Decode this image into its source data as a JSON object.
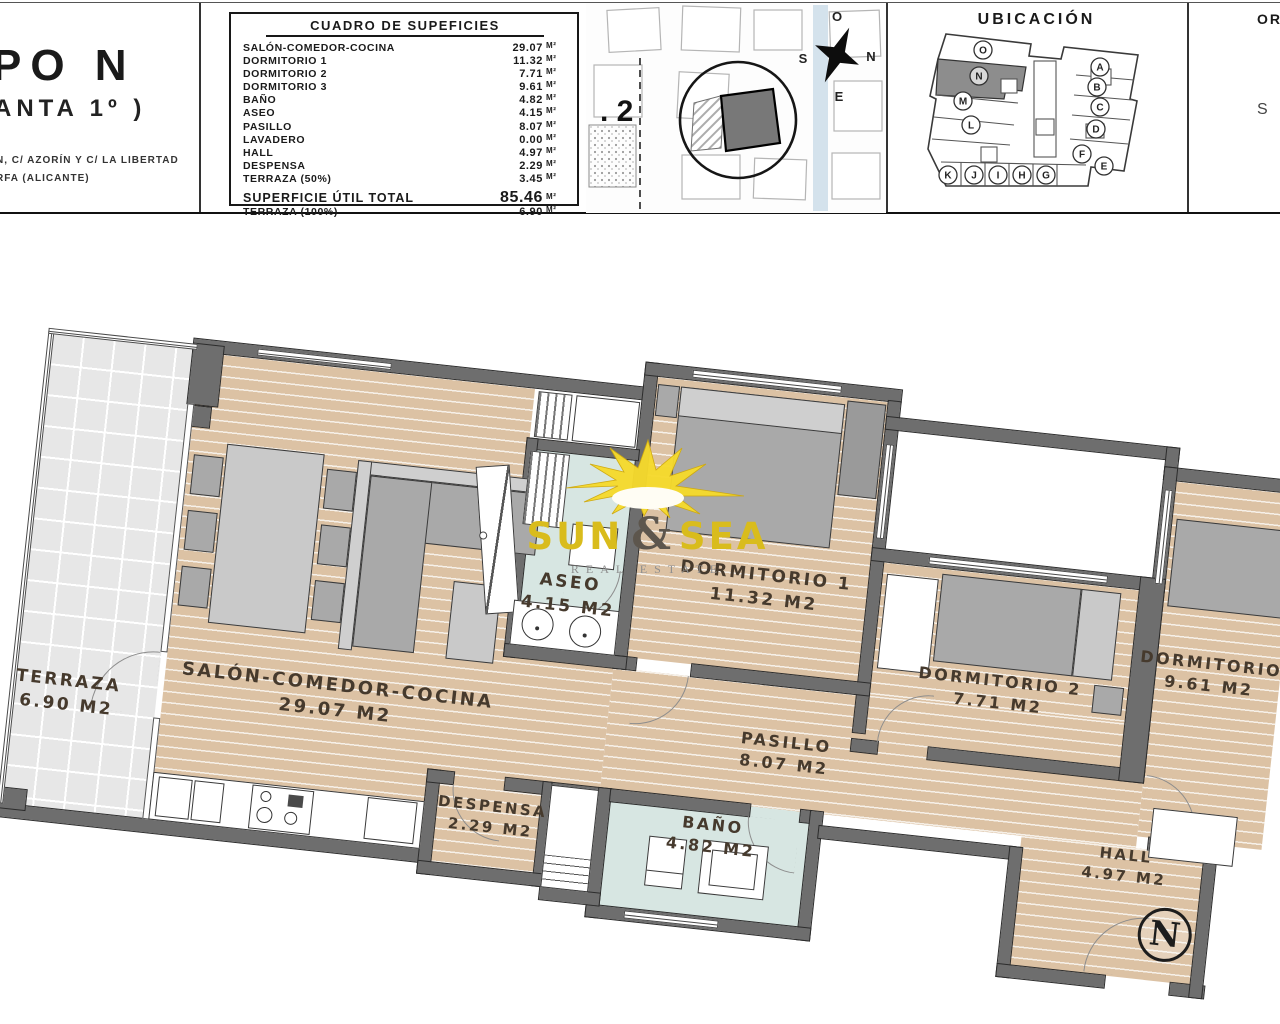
{
  "header": {
    "left": {
      "title_fragment": "PO N",
      "subtitle_fragment": "ANTA 1º )",
      "address_line1": "N, C/ AZORÍN Y C/ LA LIBERTAD",
      "address_line2": "RFA (ALICANTE)"
    },
    "surface_table": {
      "title": "CUADRO DE SUPEFICIES",
      "unit": "M²",
      "rows": [
        {
          "label": "SALÓN-COMEDOR-COCINA",
          "value": "29.07"
        },
        {
          "label": "DORMITORIO 1",
          "value": "11.32"
        },
        {
          "label": "DORMITORIO 2",
          "value": "7.71"
        },
        {
          "label": "DORMITORIO 3",
          "value": "9.61"
        },
        {
          "label": "BAÑO",
          "value": "4.82"
        },
        {
          "label": "ASEO",
          "value": "4.15"
        },
        {
          "label": "PASILLO",
          "value": "8.07"
        },
        {
          "label": "LAVADERO",
          "value": "0.00"
        },
        {
          "label": "HALL",
          "value": "4.97"
        },
        {
          "label": "DESPENSA",
          "value": "2.29"
        },
        {
          "label": "TERRAZA (50%)",
          "value": "3.45"
        }
      ],
      "total_row": {
        "label": "SUPERFICIE ÚTIL TOTAL",
        "value": "85.46"
      },
      "terraza_row": {
        "label": "TERRAZA (100%)",
        "value": "6.90"
      }
    },
    "site_map": {
      "plot_label": ". 2",
      "compass": {
        "top": "O",
        "right": "N",
        "left": "S",
        "bottom": "E"
      }
    },
    "ubicacion": {
      "title": "UBICACIÓN",
      "highlighted_unit": "N",
      "units": [
        "O",
        "N",
        "M",
        "L",
        "A",
        "B",
        "C",
        "D",
        "F",
        "E",
        "K",
        "J",
        "I",
        "H",
        "G"
      ]
    },
    "orientation": {
      "title_fragment": "OR",
      "compass_fragment": "S"
    }
  },
  "floorplan": {
    "north_label": "N",
    "rooms": {
      "terraza": {
        "name": "TERRAZA",
        "area": "6.90 M2"
      },
      "salon": {
        "name": "SALÓN-COMEDOR-COCINA",
        "area": "29.07 M2"
      },
      "aseo": {
        "name": "ASEO",
        "area": "4.15 M2"
      },
      "dormitorio1": {
        "name": "DORMITORIO 1",
        "area": "11.32 M2"
      },
      "dormitorio2": {
        "name": "DORMITORIO 2",
        "area": "7.71 M2"
      },
      "dormitorio3": {
        "name": "DORMITORIO",
        "area": "9.61 M2"
      },
      "pasillo": {
        "name": "PASILLO",
        "area": "8.07 M2"
      },
      "despensa": {
        "name": "DESPENSA",
        "area": "2.29 M2"
      },
      "bano": {
        "name": "BAÑO",
        "area": "4.82 M2"
      },
      "hall": {
        "name": "HALL",
        "area": "4.97 M2"
      }
    }
  },
  "watermark": {
    "word1": "SUN",
    "ampersand": "&",
    "word2": "SEA",
    "subtitle": "REAL ESTATE"
  },
  "colors": {
    "wall": "#6e6e6e",
    "wood": "#dcc2a4",
    "tile_blue": "#d7e6e2",
    "terrace_tile": "#e7e7e7",
    "accent_gold": "#d9bc1c"
  }
}
